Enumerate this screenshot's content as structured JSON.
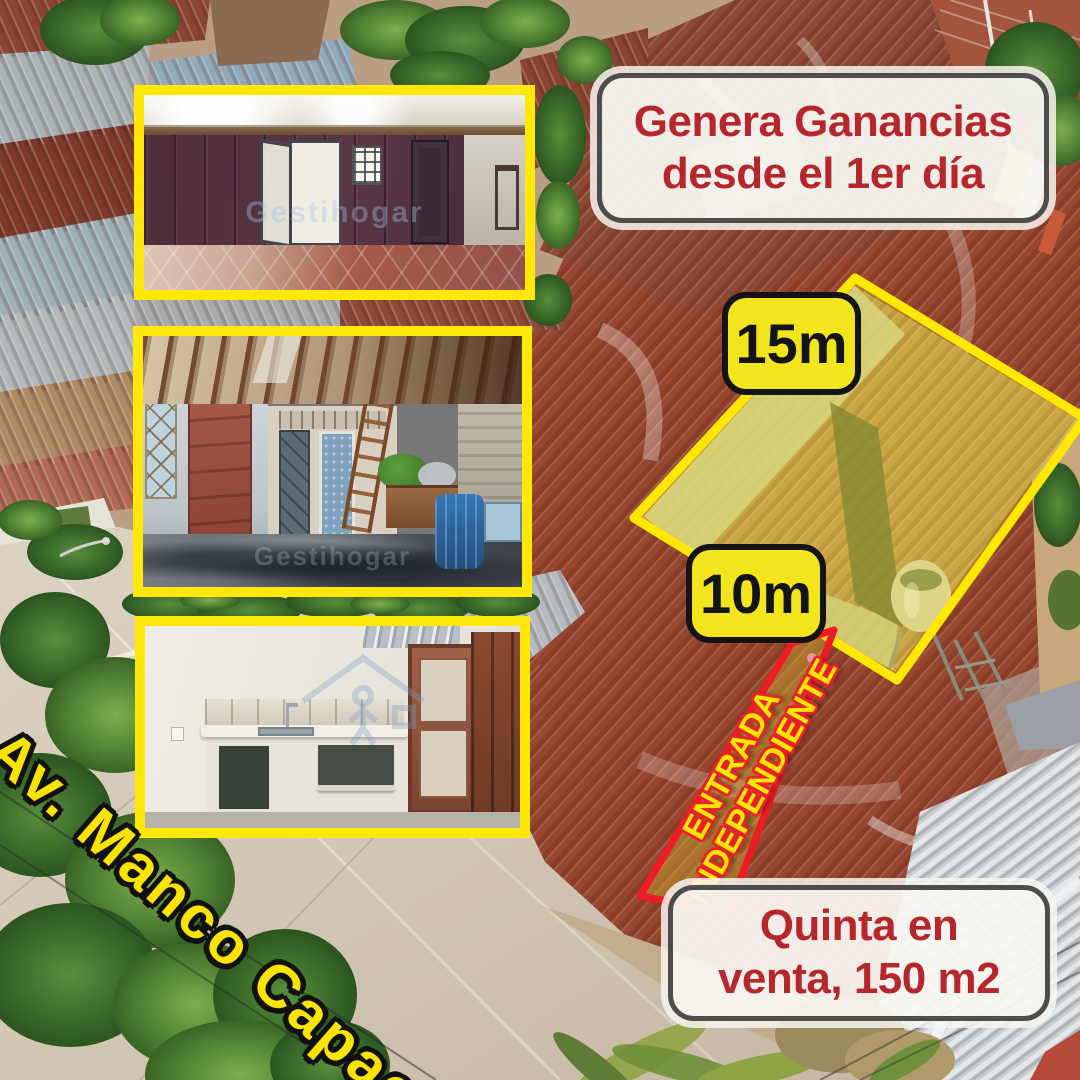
{
  "ad": {
    "headline": {
      "line1": "Genera Ganancias",
      "line2": "desde el 1er día"
    },
    "measurements": {
      "frontage": "15m",
      "depth": "10m"
    },
    "entrance": {
      "line1": "ENTRADA",
      "line2": "INDEPENDIENTE"
    },
    "sale": {
      "line1": "Quinta en",
      "line2": "venta, 150 m2"
    },
    "street": {
      "name": "Av. Manco Capac"
    },
    "watermark": {
      "brand": "Gestihogar"
    }
  },
  "colors": {
    "headline_red": "#b5272d",
    "badge_yellow": "#f2e41d",
    "photo_frame_yellow": "#ffe70a",
    "highlight_stroke_yellow": "#ffe800",
    "entrance_stroke_red": "#ee1c25",
    "entrance_text_yellow": "#ffe600",
    "street_label_yellow": "#f8e400",
    "box_border_gray": "#4d4d4d",
    "box_background": "#f8f5f0"
  }
}
